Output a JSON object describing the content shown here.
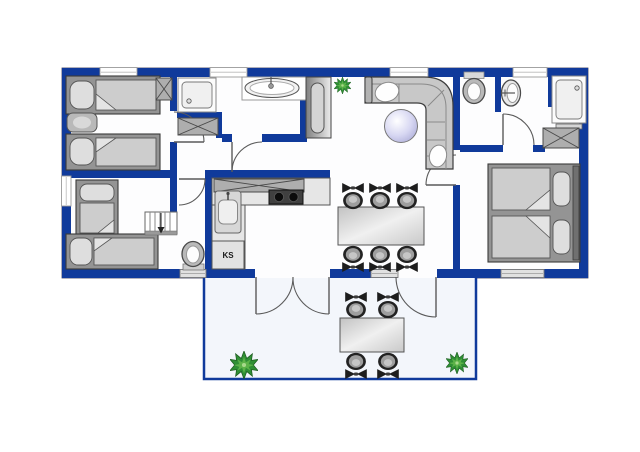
{
  "labels": {
    "fridge": "KS"
  },
  "colors": {
    "wall": "#103a9b",
    "floor": "#fdfdfe",
    "terrace_floor": "#f3f6fb",
    "plant": "#2f8f35",
    "side_table": "#c9c9ee",
    "furniture": "#c8c8c8"
  },
  "icons": {
    "plant": "plant-icon",
    "chair": "chair-icon",
    "stairs": "stairs-icon",
    "toilet": "toilet-icon",
    "washbasin": "washbasin-icon",
    "bathtub": "bathtub-icon",
    "shower": "shower-icon",
    "wardrobe": "wardrobe-x-icon",
    "stove": "stove-icon",
    "sink": "sink-icon",
    "bed": "bed-icon",
    "sofa": "sofa-icon"
  }
}
